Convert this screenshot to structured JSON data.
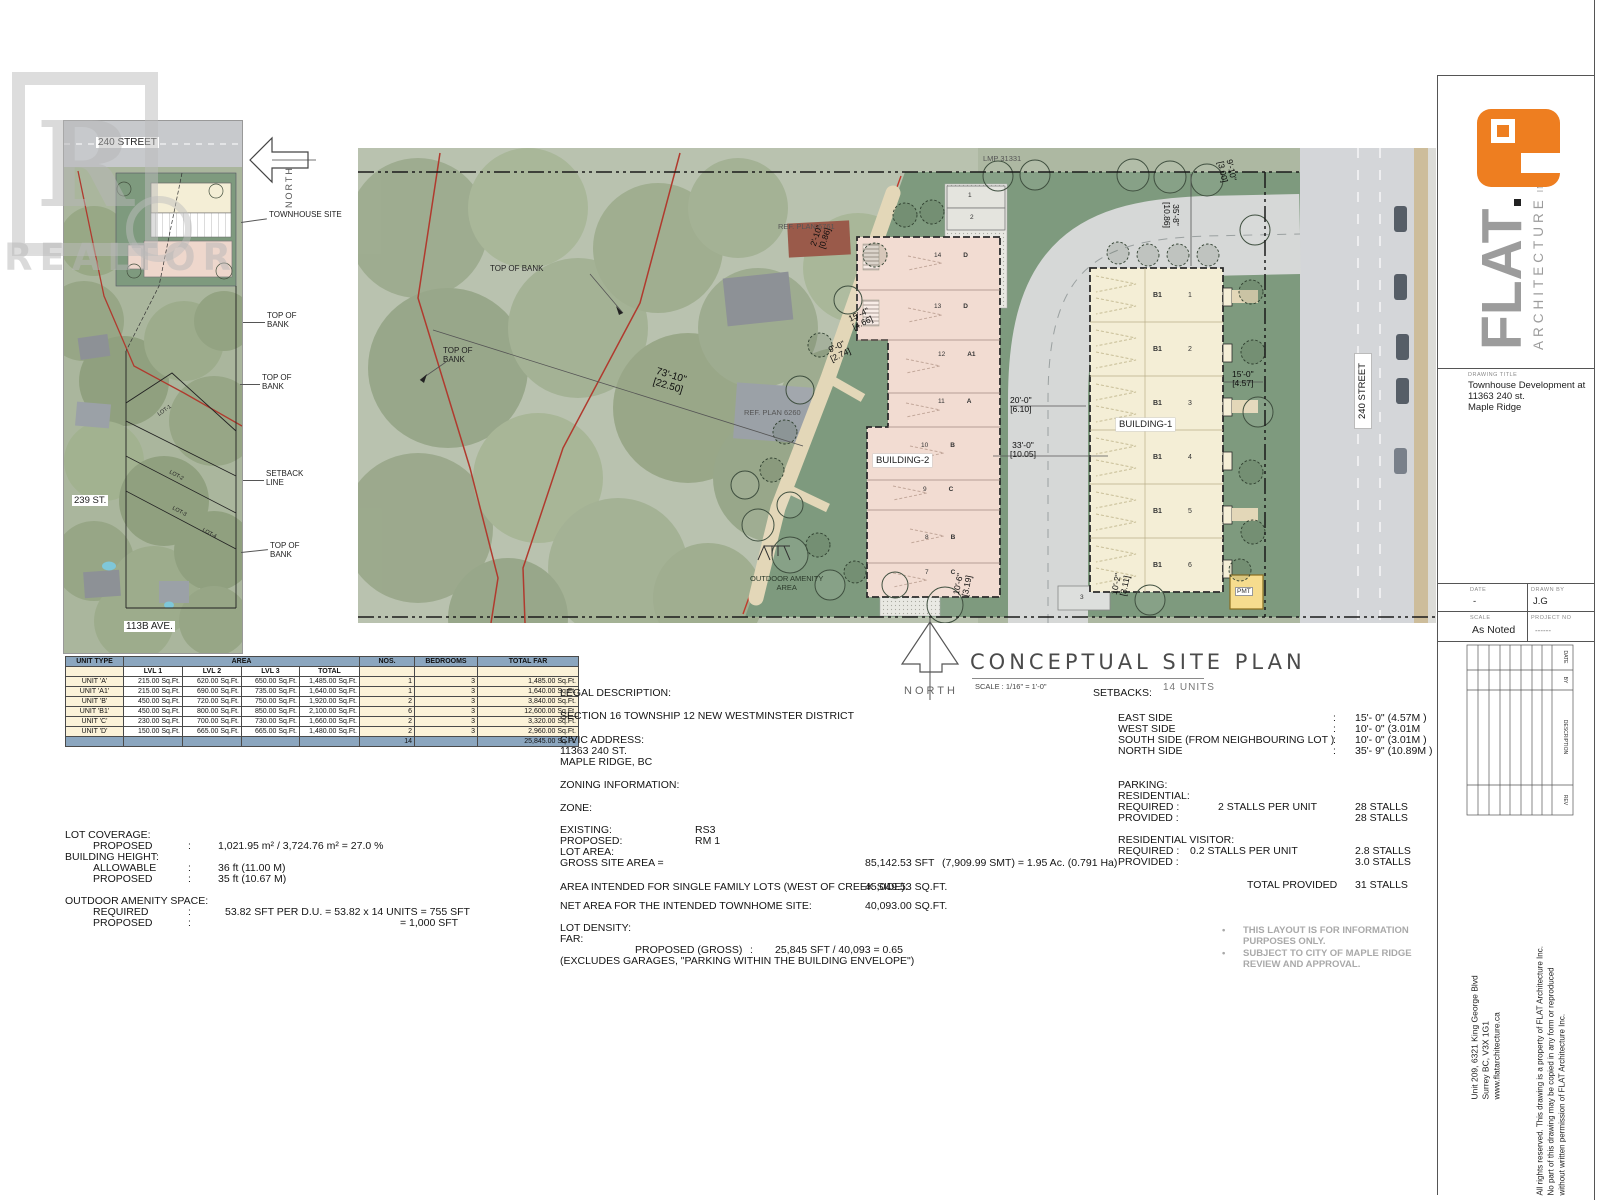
{
  "ui": {
    "colon": ":",
    "bullet": "•"
  },
  "watermark": {
    "letter": "R",
    "text": "REALTOR"
  },
  "inset": {
    "street_top": "240 STREET",
    "street_left": "239 ST.",
    "street_bottom": "113B AVE.",
    "north": "NORTH",
    "lot1": "LOT-1",
    "lot2": "LOT-2",
    "lot3": "LOT-3",
    "lot4": "LOT-4",
    "c_site": "TOWNHOUSE SITE",
    "c_tob1a": "TOP OF",
    "c_tob1b": "BANK",
    "c_tob2a": "TOP OF",
    "c_tob2b": "BANK",
    "c_set1": "SETBACK",
    "c_set2": "LINE",
    "c_tob3a": "TOP OF",
    "c_tob3b": "BANK"
  },
  "plan": {
    "boundary": "LMP 31331",
    "ref_plan_1": "REF.  PLAN  6761",
    "ref_plan_2": "REF. PLAN 6260",
    "tob1": "TOP OF BANK",
    "tob2a": "TOP OF",
    "tob2b": "BANK",
    "bank_ft": "73'-10\"",
    "bank_m": "[22.50]",
    "street": "240 STREET",
    "amenity1": "OUTDOOR AMENITY",
    "amenity2": "AREA",
    "pmt": "PMT",
    "stall1": "1",
    "stall2": "2",
    "stall3": "3",
    "building1": {
      "label": "BUILDING-1",
      "units": [
        {
          "no": "1",
          "type": "B1"
        },
        {
          "no": "2",
          "type": "B1"
        },
        {
          "no": "3",
          "type": "B1"
        },
        {
          "no": "4",
          "type": "B1"
        },
        {
          "no": "5",
          "type": "B1"
        },
        {
          "no": "6",
          "type": "B1"
        }
      ]
    },
    "building2": {
      "label": "BUILDING-2",
      "units": [
        {
          "no": "14",
          "type": "D"
        },
        {
          "no": "13",
          "type": "D"
        },
        {
          "no": "12",
          "type": "A1"
        },
        {
          "no": "11",
          "type": "A"
        },
        {
          "no": "10",
          "type": "B"
        },
        {
          "no": "9",
          "type": "C"
        },
        {
          "no": "8",
          "type": "B"
        },
        {
          "no": "7",
          "type": "C"
        }
      ]
    },
    "dims": {
      "d1_ft": "2'-10\"",
      "d1_m": "[0.86]",
      "d2_ft": "15'-4\"",
      "d2_m": "[4.66]",
      "d3_ft": "9'-0\"",
      "d3_m": "[2.74]",
      "d4_ft": "10'-6\"",
      "d4_m": "[3.19]",
      "d5_ft": "10'-2\"",
      "d5_m": "[3.11]",
      "d6_ft": "20'-0\"",
      "d6_m": "[6.10]",
      "d7_ft": "33'-0\"",
      "d7_m": "[10.05]",
      "d8_ft": "35'-8\"",
      "d8_m": "[10.86]",
      "d9_ft": "9'-10\"",
      "d9_m": "[3.00]",
      "d10_ft": "15'-0\"",
      "d10_m": "[4.57]"
    }
  },
  "title": {
    "north": "NORTH",
    "main": "CONCEPTUAL SITE PLAN",
    "scale": "SCALE : 1/16\" = 1'-0\"",
    "units_count": "14 UNITS"
  },
  "unit_table": {
    "h_unit": "UNIT TYPE",
    "h_area": "AREA",
    "h_nos": "NOS.",
    "h_bed": "BEDROOMS",
    "h_far": "TOTAL FAR",
    "h_lvl1": "LVL 1",
    "h_lvl2": "LVL 2",
    "h_lvl3": "LVL 3",
    "h_total": "TOTAL",
    "rows": [
      {
        "name": "UNIT 'A'",
        "l1": "215.00 Sq.Ft.",
        "l2": "620.00 Sq.Ft.",
        "l3": "650.00 Sq.Ft.",
        "tot": "1,485.00 Sq.Ft.",
        "nos": "1",
        "bed": "3",
        "far": "1,485.00 Sq.Ft."
      },
      {
        "name": "UNIT 'A1'",
        "l1": "215.00 Sq.Ft.",
        "l2": "690.00 Sq.Ft.",
        "l3": "735.00 Sq.Ft.",
        "tot": "1,640.00 Sq.Ft.",
        "nos": "1",
        "bed": "3",
        "far": "1,640.00 Sq.Ft."
      },
      {
        "name": "UNIT 'B'",
        "l1": "450.00 Sq.Ft.",
        "l2": "720.00 Sq.Ft.",
        "l3": "750.00 Sq.Ft.",
        "tot": "1,920.00 Sq.Ft.",
        "nos": "2",
        "bed": "3",
        "far": "3,840.00 Sq.Ft."
      },
      {
        "name": "UNIT 'B1'",
        "l1": "450.00 Sq.Ft.",
        "l2": "800.00 Sq.Ft.",
        "l3": "850.00 Sq.Ft.",
        "tot": "2,100.00 Sq.Ft.",
        "nos": "6",
        "bed": "3",
        "far": "12,600.00 Sq.Ft."
      },
      {
        "name": "UNIT 'C'",
        "l1": "230.00 Sq.Ft.",
        "l2": "700.00 Sq.Ft.",
        "l3": "730.00 Sq.Ft.",
        "tot": "1,660.00 Sq.Ft.",
        "nos": "2",
        "bed": "3",
        "far": "3,320.00 Sq.Ft."
      },
      {
        "name": "UNIT 'D'",
        "l1": "150.00 Sq.Ft.",
        "l2": "665.00 Sq.Ft.",
        "l3": "665.00 Sq.Ft.",
        "tot": "1,480.00 Sq.Ft.",
        "nos": "2",
        "bed": "3",
        "far": "2,960.00 Sq.Ft."
      }
    ],
    "total_nos": "14",
    "total_far": "25,845.00 Sq.Ft."
  },
  "lot_info": {
    "h_cov": "LOT COVERAGE:",
    "cov_l": "PROPOSED",
    "cov_v": "1,021.95 m² / 3,724.76 m² =  27.0 %",
    "h_height": "BUILDING HEIGHT:",
    "al_l": "ALLOWABLE",
    "al_v": "36 ft (11.00 M)",
    "pr_l": "PROPOSED",
    "pr_v": "35 ft (10.67 M)",
    "h_amen": "OUTDOOR AMENITY SPACE:",
    "req_l": "REQUIRED",
    "req_v": "53.82 SFT PER D.U. = 53.82  x 14 UNITS = 755 SFT",
    "pro_l": "PROPOSED",
    "pro_v": "= 1,000 SFT"
  },
  "legal": {
    "h1": "LEGAL DESCRIPTION:",
    "section": "SECTION 16 TOWNSHIP 12 NEW WESTMINSTER DISTRICT",
    "h2": "CIVIC ADDRESS:",
    "addr1": "11363 240 ST.",
    "addr2": "MAPLE RIDGE, BC",
    "h3": "ZONING INFORMATION:",
    "h4": "ZONE:",
    "exist_l": "EXISTING:",
    "exist_v": "RS3",
    "prop_l": "PROPOSED:",
    "prop_v": "RM 1",
    "lot_area": "LOT AREA:",
    "gross_l": "GROSS SITE AREA =",
    "gross_v1": "85,142.53 SFT",
    "gross_v2": "(7,909.99 SMT) = 1.95 Ac. (0.791 Ha)",
    "sf_l": "AREA INTENDED FOR SINGLE FAMILY LOTS (WEST OF CREEK SIDE):",
    "sf_v": "45,049.53 SQ.FT.",
    "net_l": "NET AREA FOR THE INTENDED TOWNHOME SITE:",
    "net_v": "40,093.00 SQ.FT.",
    "h5": "LOT DENSITY:",
    "h6": "FAR:",
    "far_l": "PROPOSED (GROSS)",
    "far_v": "25,845 SFT / 40,093 = 0.65",
    "far_note": "(EXCLUDES GARAGES, \"PARKING WITHIN THE BUILDING ENVELOPE\")"
  },
  "setbacks": {
    "title": "SETBACKS:",
    "rows": [
      {
        "l": "EAST SIDE",
        "v": "15'- 0\" (4.57M )"
      },
      {
        "l": "WEST SIDE",
        "v": "10'- 0\" (3.01M"
      },
      {
        "l": "SOUTH SIDE (FROM NEIGHBOURING LOT )",
        "v": "10'- 0\" (3.01M )"
      },
      {
        "l": "NORTH SIDE",
        "v": "35'- 9\" (10.89M )"
      }
    ],
    "parking": "PARKING:",
    "residential": "RESIDENTIAL:",
    "req_l": "REQUIRED :",
    "req_rate": "2 STALLS PER UNIT",
    "req_v": "28  STALLS",
    "prov_l": "PROVIDED :",
    "prov_v": "28 STALLS",
    "visitor": "RESIDENTIAL VISITOR:",
    "vreq_l": "REQUIRED :",
    "vreq_rate": "0.2 STALLS PER UNIT",
    "vreq_v": "2.8 STALLS",
    "vprov_l": "PROVIDED :",
    "vprov_v": "3.0 STALLS",
    "total_l": "TOTAL PROVIDED",
    "total_v": "31 STALLS"
  },
  "notes": {
    "b1a": "THIS LAYOUT IS  FOR INFORMATION",
    "b1b": "PURPOSES ONLY.",
    "b2a": "SUBJECT TO CITY OF MAPLE RIDGE",
    "b2b": "REVIEW AND APPROVAL."
  },
  "titleblock": {
    "logo_word": "FLAT",
    "logo_sub": "ARCHITECTURE",
    "logo_inc": "INC.",
    "drawing_title_label": "DRAWING TITLE",
    "drawing_title_1": "Townhouse Development at",
    "drawing_title_2": "11363 240 st.",
    "drawing_title_3": "Maple Ridge",
    "date_label": "DATE",
    "date": "-",
    "drawn_label": "DRAWN BY",
    "drawn": "J.G",
    "scale_label": "SCALE",
    "scale": "As Noted",
    "project_label": "PROJECT NO",
    "project": "------",
    "rev_date": "DATE",
    "rev_by": "BY",
    "rev_desc": "DESCRIPTION",
    "rev_rev": "REV",
    "address_1": "Unit 209, 6321 King George Blvd",
    "address_2": "Surrey BC, V3X 1G1",
    "address_3": "www.flatarchitecture.ca",
    "copy_1": "All rights reserved. This drawing is a property of FLAT Architecture Inc.",
    "copy_2": "No part of this drawing may be copied in any form or reproduced",
    "copy_3": "without written permission of FLAT Architecture Inc."
  }
}
